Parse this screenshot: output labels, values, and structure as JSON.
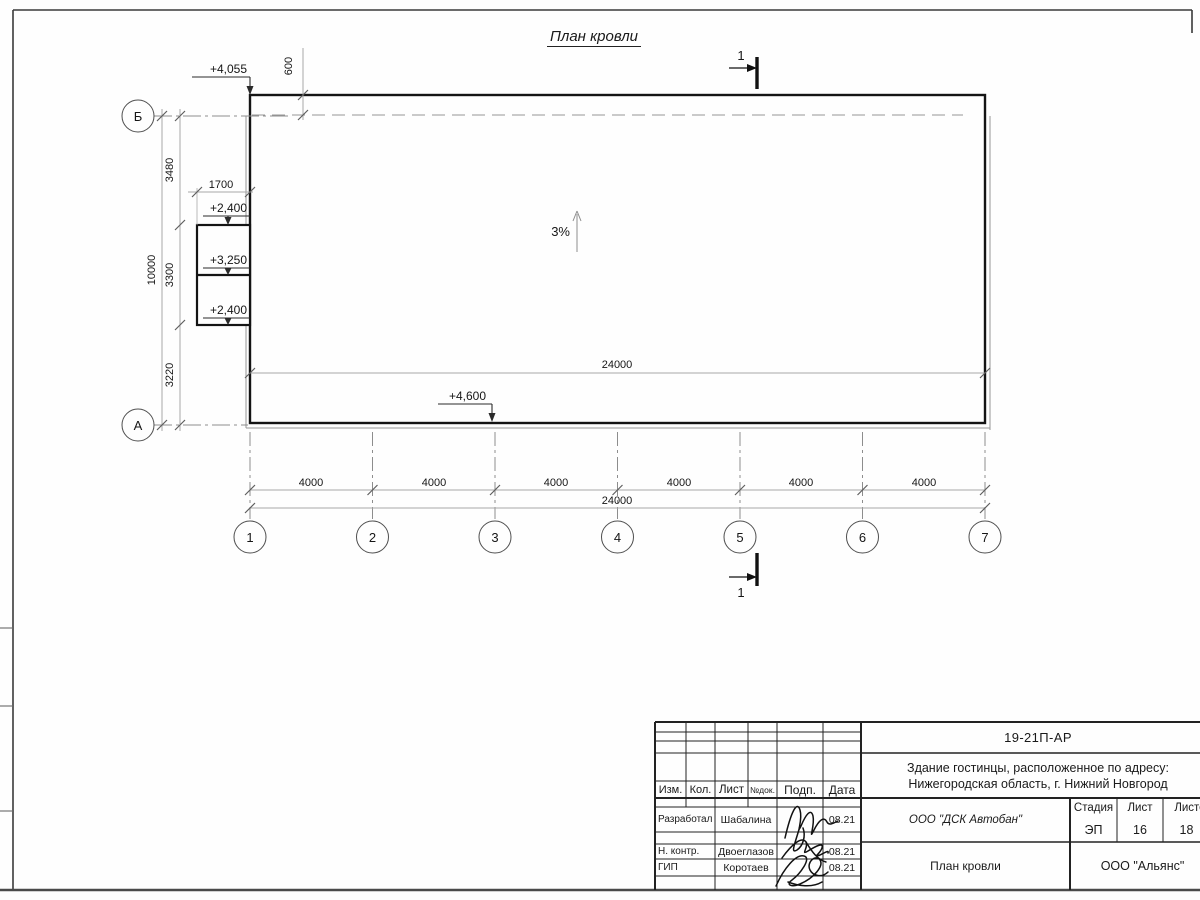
{
  "drawing": {
    "title": "План кровли",
    "slope": "3%",
    "section": "1",
    "elev": {
      "corner": "+4,055",
      "annex_top": "+2,400",
      "annex_mid": "+3,250",
      "annex_bot": "+2,400",
      "canopy": "+4,600"
    },
    "dims": {
      "overhang": "600",
      "annex_width": "1700",
      "left_segments": [
        "3480",
        "3300",
        "3220"
      ],
      "left_total": "10000",
      "inner_total": "24000",
      "bottom_segments": [
        "4000",
        "4000",
        "4000",
        "4000",
        "4000",
        "4000"
      ],
      "bottom_total": "24000"
    },
    "axes": {
      "rows": [
        "Б",
        "А"
      ],
      "cols": [
        "1",
        "2",
        "3",
        "4",
        "5",
        "6",
        "7"
      ]
    }
  },
  "titleblock": {
    "doc_number": "19-21П-АР",
    "project_name": "Здание гостинцы, расположенное по адресу: Нижегородская область, г. Нижний Новгород",
    "header_cells": [
      "Изм.",
      "Кол.",
      "Лист",
      "№док.",
      "Подп.",
      "Дата"
    ],
    "rows": [
      {
        "role": "Разработал",
        "name": "Шабалина",
        "date": "08.21"
      },
      {
        "role": "Н. контр.",
        "name": "Двоеглазов",
        "date": "08.21"
      },
      {
        "role": "ГИП",
        "name": "Коротаев",
        "date": "08.21"
      }
    ],
    "company": "ООО \"ДСК Автобан\"",
    "sheet_title": "План кровли",
    "stage_label": "Стадия",
    "sheet_label": "Лист",
    "sheets_label": "Листов",
    "stage": "ЭП",
    "sheet": "16",
    "sheets": "18",
    "org": "ООО \"Альянс\""
  }
}
